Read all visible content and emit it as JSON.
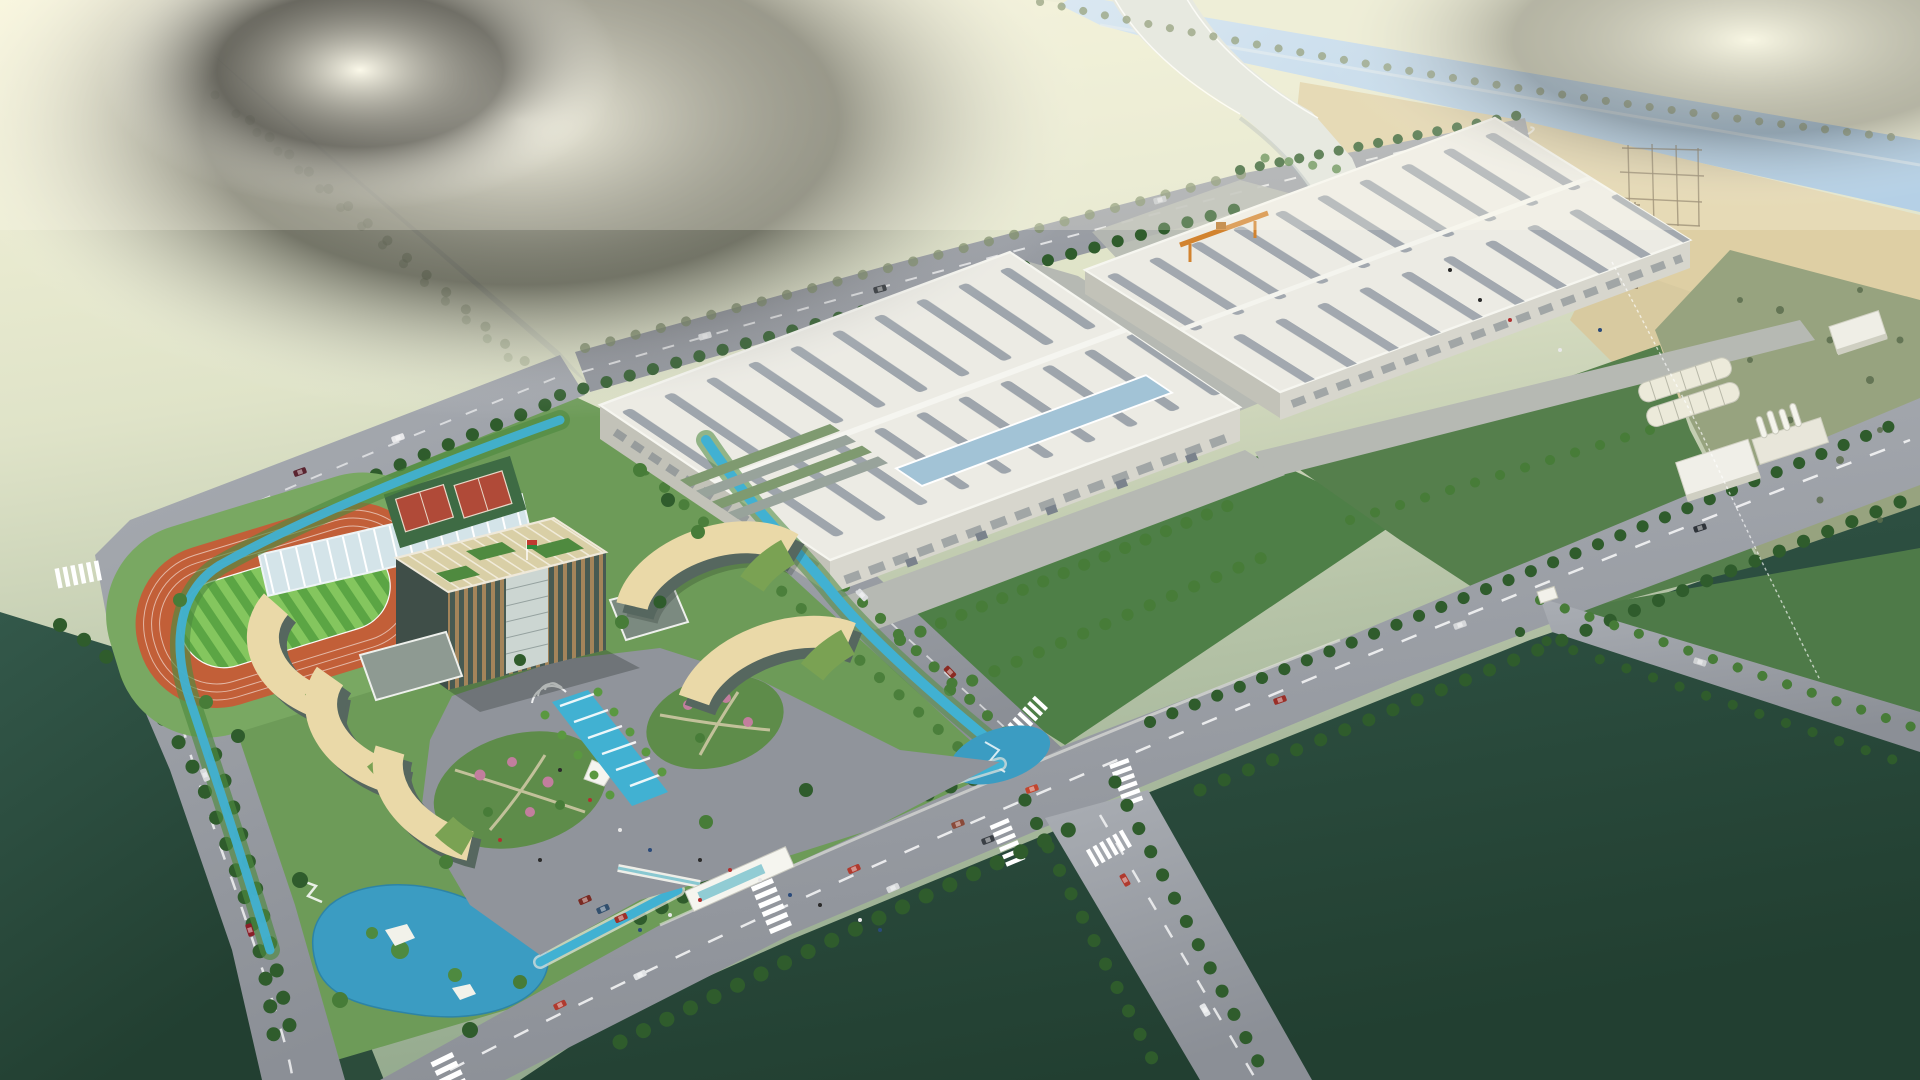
{
  "scene": {
    "title": "Aerial architectural rendering of an industrial park campus",
    "description": "Bird's-eye 3D rendering: landscaped office campus with glass tower, curved dormitory buildings, running track, ponds and fountain plaza on the left; two large white factory halls with roof vents in the center-right; a light-blue canal with an arched bridge and a construction site at the top right; tree-lined boulevards, intersections with crosswalks, scattered cars, and dark green fields in the foreground; hazy sunlit fields at the upper left.",
    "elements": [
      {
        "name": "office-tower",
        "desc": "High-rise with gold/glass facade, rooftop garden and flag"
      },
      {
        "name": "curved-buildings",
        "desc": "Five crescent-shaped buildings with cream roofs and green terraces"
      },
      {
        "name": "running-track",
        "desc": "Orange athletics track with striped green infield"
      },
      {
        "name": "sports-courts",
        "desc": "Two red courts on green pad"
      },
      {
        "name": "greenhouse",
        "desc": "Long glass-roofed building along north road"
      },
      {
        "name": "fountain-plaza",
        "desc": "Gray plaza with cascading blue fountain, palms, flower gardens, white canopy"
      },
      {
        "name": "ponds-and-streams",
        "desc": "Teal ponds with white platforms and winding streams around the campus"
      },
      {
        "name": "entrance-gate",
        "desc": "White gate canopy with crosswalk on the boulevard"
      },
      {
        "name": "front-factory",
        "desc": "Large white factory hall with rows of roof vents and blue skylight band"
      },
      {
        "name": "rear-factory",
        "desc": "Second large factory hall with orange gantry crane"
      },
      {
        "name": "sheds-and-silos",
        "desc": "Barrel-vault sheds and white silo/chimney unit at right"
      },
      {
        "name": "river-and-bridge",
        "desc": "Light blue canal crossed by white arched bridge"
      },
      {
        "name": "construction-site",
        "desc": "Steel frame under construction on sandy ground near the river"
      },
      {
        "name": "roads",
        "desc": "Tree-lined boulevard, crossroads, riverside road and hazy distant highway"
      },
      {
        "name": "fields",
        "desc": "Dark green foreground fields, pale sunlit distant fields"
      }
    ],
    "vehicle_count": 25,
    "people_count": 21
  },
  "palette": {
    "haze_top": "#f6f4da",
    "haze_mid": "#dfe3c8",
    "sage": "#b3c1a4",
    "sage_deep": "#93a98e",
    "far_field": "#e9ead0",
    "river": "#a9cbe8",
    "river_hi": "#c6def2",
    "sand": "#decfa4",
    "scrub": "#97a37f",
    "road": "#9b9fa6",
    "road_far": "#b6b9b3",
    "road_dark": "#84888f",
    "road_line": "#ffffff",
    "dark_field": "#2c4c3b",
    "dark_field2": "#1f3c2f",
    "lawn": "#4e7f47",
    "campus_grass": "#6d9b58",
    "campus_grass2": "#79a862",
    "track": "#c25f38",
    "stripe_a": "#83ca60",
    "stripe_b": "#58a845",
    "court": "#b04a38",
    "court_pad": "#3e6b44",
    "roof_white": "#ecebe4",
    "roof_shade": "#dcdbd2",
    "vent": "#9aa1a9",
    "skylight": "#a2c3d6",
    "wall": "#d7d6cd",
    "wall_dark": "#c2c2b8",
    "cream": "#ead9a8",
    "glass_dark": "#56675f",
    "terrace": "#7aa253",
    "tower_gold": "#a3845a",
    "tower_glass": "#475a52",
    "tower_core": "#ccd6d2",
    "roofgarden": "#d9cfa6",
    "pond": "#3b9cc2",
    "stream": "#41b1d2",
    "tree_dark": "#2f5c2c",
    "tree_mid": "#477c38",
    "tree_bright": "#5a9840",
    "tree_olive": "#7b8b64",
    "blossom": "#c27e9e",
    "plaza": "#90949b",
    "path": "#d3caa8",
    "canopy": "#f5f5ef",
    "crane": "#d2832f",
    "steel": "#6f5f45",
    "bridge": "#dfe3dd"
  },
  "vehicles": [
    {
      "x": 854,
      "y": 869,
      "r": -23,
      "c": "#b03a2e"
    },
    {
      "x": 893,
      "y": 888,
      "r": -23,
      "c": "#d8dadc"
    },
    {
      "x": 958,
      "y": 824,
      "r": -21,
      "c": "#8a4a3a"
    },
    {
      "x": 988,
      "y": 840,
      "r": -21,
      "c": "#3a3f45"
    },
    {
      "x": 1032,
      "y": 789,
      "r": -20,
      "c": "#c2452e"
    },
    {
      "x": 1280,
      "y": 700,
      "r": -20,
      "c": "#9a2f28"
    },
    {
      "x": 1460,
      "y": 625,
      "r": -19,
      "c": "#d5d7d9"
    },
    {
      "x": 1700,
      "y": 528,
      "r": -18,
      "c": "#2f343a"
    },
    {
      "x": 560,
      "y": 1005,
      "r": -26,
      "c": "#b03a2e"
    },
    {
      "x": 640,
      "y": 975,
      "r": -26,
      "c": "#e2e4e6"
    },
    {
      "x": 250,
      "y": 930,
      "r": 72,
      "c": "#8a1e28"
    },
    {
      "x": 205,
      "y": 775,
      "r": 68,
      "c": "#d8dadc"
    },
    {
      "x": 398,
      "y": 438,
      "r": 160,
      "c": "#e8e8ea"
    },
    {
      "x": 300,
      "y": 472,
      "r": 160,
      "c": "#5a2430"
    },
    {
      "x": 705,
      "y": 336,
      "r": -15,
      "c": "#e4e6e8"
    },
    {
      "x": 880,
      "y": 289,
      "r": -15,
      "c": "#2e3338"
    },
    {
      "x": 1160,
      "y": 200,
      "r": -15,
      "c": "#c0c4c8"
    },
    {
      "x": 1125,
      "y": 880,
      "r": 60,
      "c": "#b03a2e"
    },
    {
      "x": 1205,
      "y": 1010,
      "r": 60,
      "c": "#e4e6e8"
    },
    {
      "x": 950,
      "y": 672,
      "r": 46,
      "c": "#8a2a22"
    },
    {
      "x": 862,
      "y": 595,
      "r": 46,
      "c": "#dcdee0"
    },
    {
      "x": 585,
      "y": 900,
      "r": -24,
      "c": "#7a2a22"
    },
    {
      "x": 603,
      "y": 909,
      "r": -24,
      "c": "#32506e"
    },
    {
      "x": 621,
      "y": 918,
      "r": -24,
      "c": "#a03028"
    },
    {
      "x": 1700,
      "y": 662,
      "r": 17,
      "c": "#d0d2d4"
    }
  ],
  "people": [
    {
      "x": 560,
      "y": 770
    },
    {
      "x": 590,
      "y": 800
    },
    {
      "x": 620,
      "y": 830
    },
    {
      "x": 650,
      "y": 850
    },
    {
      "x": 700,
      "y": 860
    },
    {
      "x": 730,
      "y": 870
    },
    {
      "x": 760,
      "y": 880
    },
    {
      "x": 790,
      "y": 895
    },
    {
      "x": 820,
      "y": 905
    },
    {
      "x": 700,
      "y": 900
    },
    {
      "x": 670,
      "y": 915
    },
    {
      "x": 640,
      "y": 930
    },
    {
      "x": 540,
      "y": 860
    },
    {
      "x": 500,
      "y": 840
    },
    {
      "x": 860,
      "y": 920
    },
    {
      "x": 880,
      "y": 930
    },
    {
      "x": 1480,
      "y": 300
    },
    {
      "x": 1510,
      "y": 320
    },
    {
      "x": 1560,
      "y": 350
    },
    {
      "x": 1600,
      "y": 330
    },
    {
      "x": 1450,
      "y": 270
    }
  ]
}
